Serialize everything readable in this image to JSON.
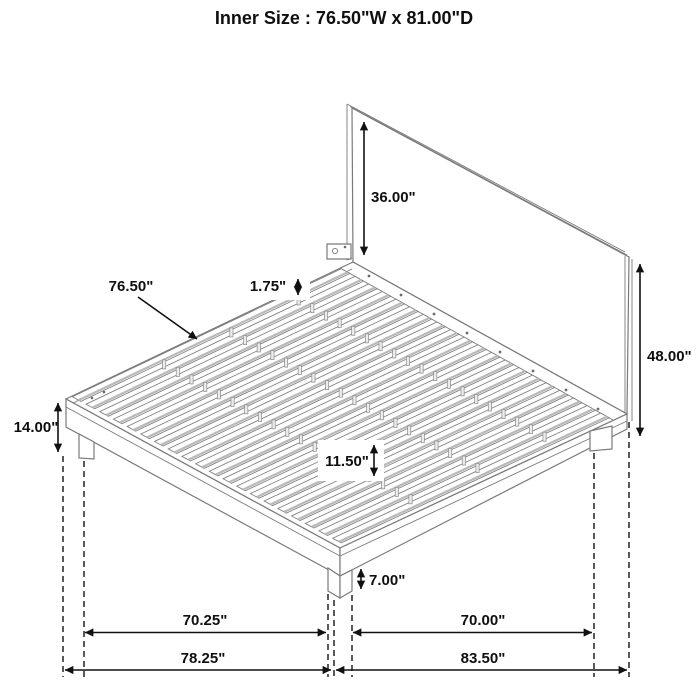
{
  "title": "Inner Size : 76.50\"W x 81.00\"D",
  "dimensions": {
    "headboard_height": "36.00\"",
    "slat_span_width": "76.50\"",
    "slat_thickness": "1.75\"",
    "overall_height": "48.00\"",
    "platform_top_height": "14.00\"",
    "slat_segment_length": "11.50\"",
    "underbed_clearance": "7.00\"",
    "front_leg_span": "70.25\"",
    "side_leg_span": "70.00\"",
    "front_overall_length": "78.25\"",
    "side_overall_length": "83.50\""
  },
  "colors": {
    "drawing_line": "#7a7a7a",
    "dimension_line": "#111111",
    "background": "#ffffff"
  }
}
